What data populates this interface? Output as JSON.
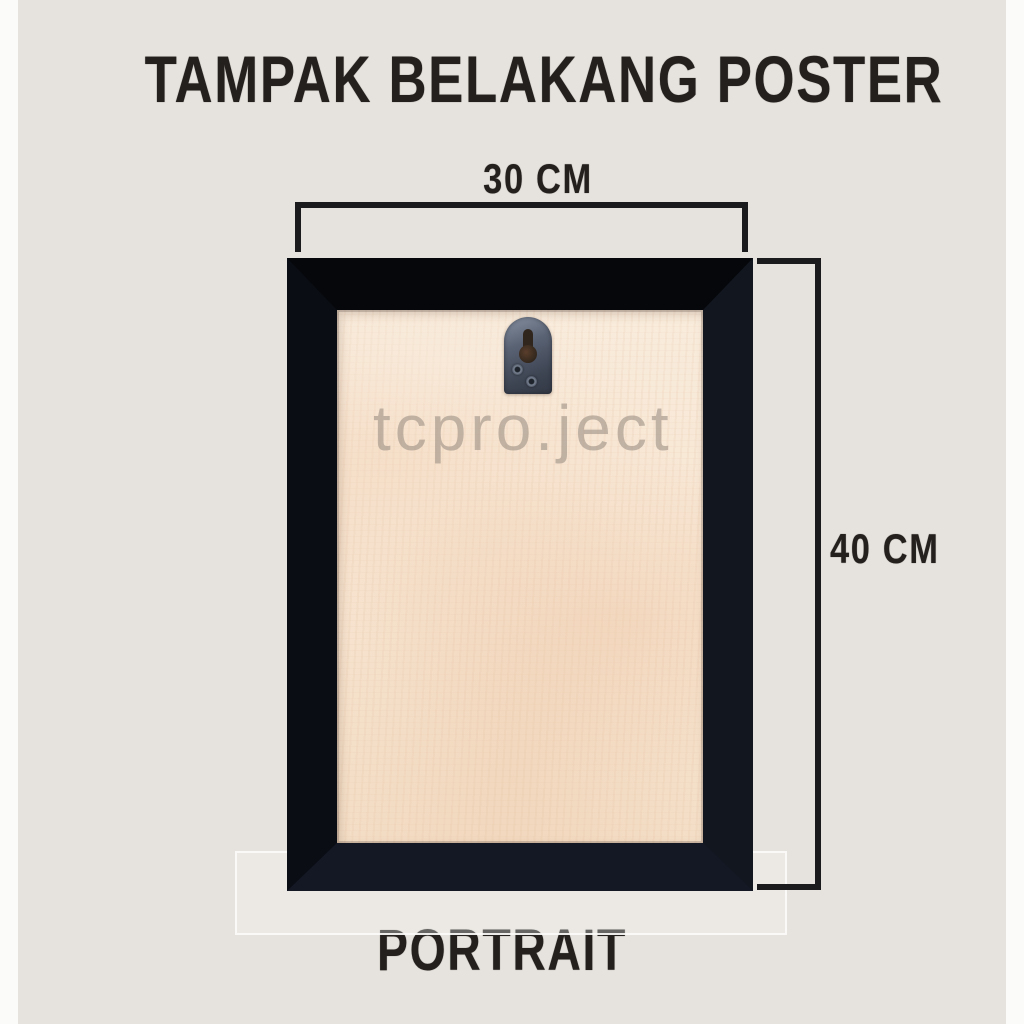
{
  "title": "TAMPAK BELAKANG POSTER",
  "frame": {
    "width_label": "30 CM",
    "height_label": "40 CM",
    "orientation": "PORTRAIT",
    "watermark": "tcpro.ject"
  },
  "colors": {
    "background": "#e6e2dd",
    "side_strip": "#fbfbfa",
    "ink_black": "#23201e",
    "dimension_line": "#1b1a1c",
    "frame_black": "#0a0d14",
    "wood_panel": "#f7e5d2",
    "hanger_metal": "#5a6374",
    "watermark_gray": "#94887e"
  }
}
